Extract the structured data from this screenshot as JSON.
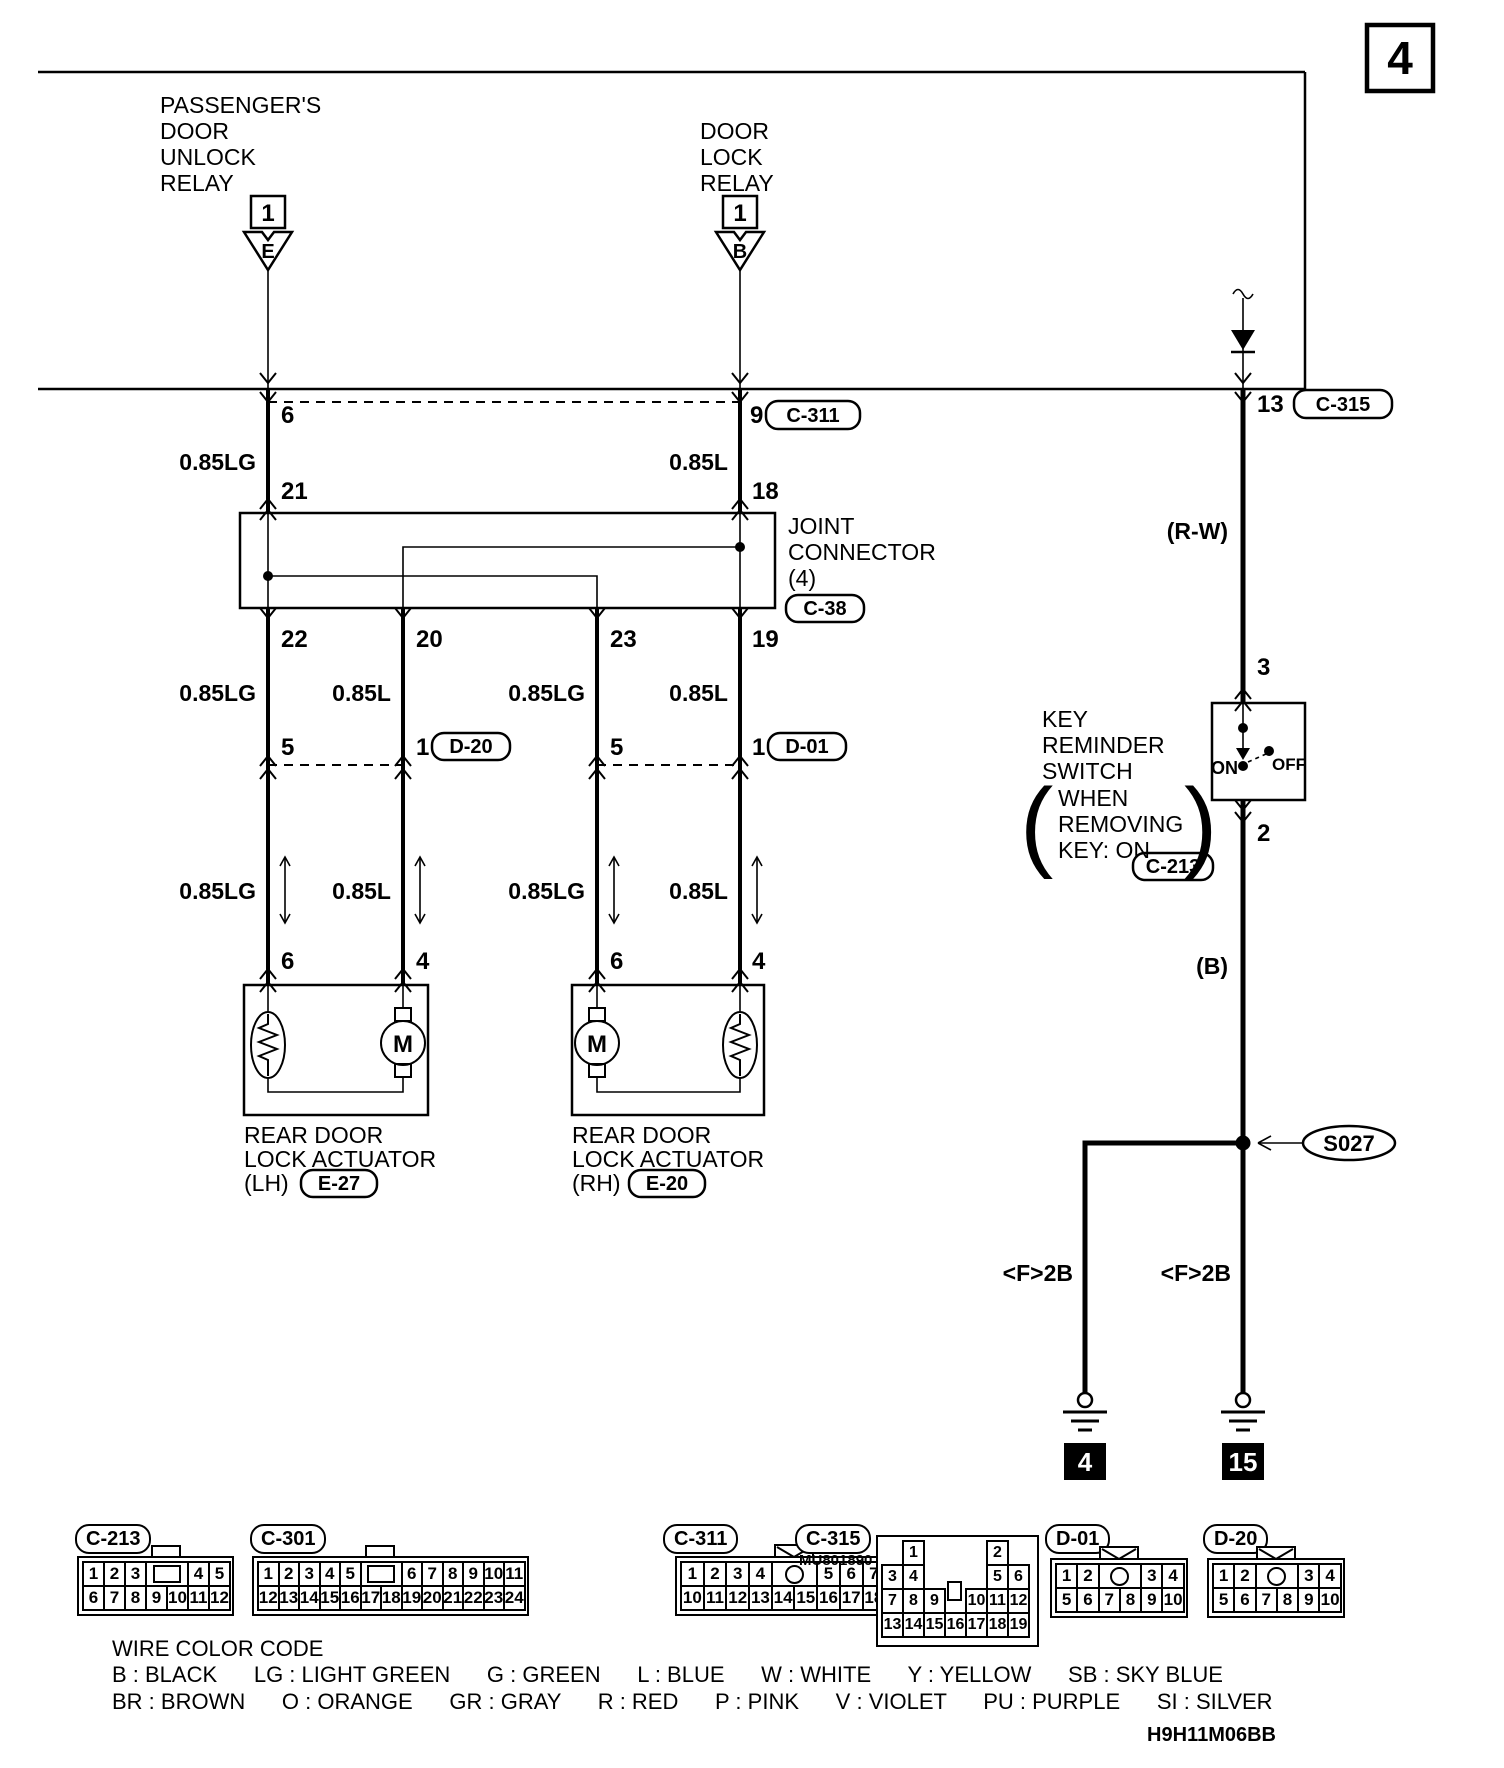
{
  "page": {
    "number": "4",
    "code": "H9H11M06BB"
  },
  "unlock_relay": {
    "line1": "PASSENGER'S",
    "line2": "DOOR",
    "line3": "UNLOCK",
    "line4": "RELAY",
    "pin": "1",
    "terminal": "E"
  },
  "lock_relay": {
    "line1": "DOOR",
    "line2": "LOCK",
    "line3": "RELAY",
    "pin": "1",
    "terminal": "B"
  },
  "columns": {
    "a": {
      "top_pin": "6",
      "top_gauge": "0.85LG",
      "jc_in": "21",
      "jc_out": "22",
      "gauge2": "0.85LG",
      "pin2": "5",
      "gauge3": "0.85LG",
      "act_pin": "6"
    },
    "b": {
      "jc_out": "20",
      "gauge2": "0.85L",
      "pin2": "1",
      "conn": "D-20",
      "gauge3": "0.85L",
      "act_pin": "4"
    },
    "c": {
      "jc_out": "23",
      "gauge2": "0.85LG",
      "pin2": "5",
      "gauge3": "0.85LG",
      "act_pin": "6"
    },
    "d": {
      "top_pin": "9",
      "top_conn": "C-311",
      "top_gauge": "0.85L",
      "jc_in": "18",
      "jc_out": "19",
      "gauge2": "0.85L",
      "pin2": "1",
      "conn": "D-01",
      "gauge3": "0.85L",
      "act_pin": "4"
    }
  },
  "joint_connector": {
    "line1": "JOINT",
    "line2": "CONNECTOR",
    "line3": "(4)",
    "code": "C-38"
  },
  "actuator_lh": {
    "line1": "REAR DOOR",
    "line2": "LOCK ACTUATOR",
    "line3": "(LH)",
    "code": "E-27",
    "motor": "M"
  },
  "actuator_rh": {
    "line1": "REAR DOOR",
    "line2": "LOCK ACTUATOR",
    "line3": "(RH)",
    "code": "E-20",
    "motor": "M"
  },
  "right": {
    "pin_top": "13",
    "conn_top": "C-315",
    "wire_top": "(R-W)",
    "pin3": "3",
    "pin2": "2",
    "wire_mid": "(B)",
    "splice": "S027",
    "sub_left": "<F>2B",
    "sub_right": "<F>2B",
    "ground_left": "4",
    "ground_right": "15"
  },
  "key_switch": {
    "line1": "KEY",
    "line2": "REMINDER",
    "line3": "SWITCH",
    "cond1": "WHEN",
    "cond2": "REMOVING",
    "cond3": "KEY: ON",
    "paren_open": "(",
    "paren_close": ")",
    "on": "ON",
    "off": "OFF",
    "code": "C-213"
  },
  "legend": {
    "title": "WIRE COLOR CODE",
    "line1": "B : BLACK      LG : LIGHT GREEN      G : GREEN      L : BLUE      W : WHITE      Y : YELLOW      SB : SKY BLUE",
    "line2": "BR : BROWN      O : ORANGE      GR : GRAY      R : RED      P : PINK      V : VIOLET      PU : PURPLE      SI : SILVER"
  },
  "connectors": [
    {
      "code": "C-213",
      "tab": "rect",
      "rows": [
        [
          "1",
          "2",
          "3",
          "#tab",
          "4",
          "5"
        ],
        [
          "6",
          "7",
          "8",
          "9",
          "10",
          "11",
          "12"
        ]
      ]
    },
    {
      "code": "C-301",
      "tab": "rect",
      "rows": [
        [
          "1",
          "2",
          "3",
          "4",
          "5",
          "#tab",
          "6",
          "7",
          "8",
          "9",
          "10",
          "11"
        ],
        [
          "12",
          "13",
          "14",
          "15",
          "16",
          "17",
          "18",
          "19",
          "20",
          "21",
          "22",
          "23",
          "24"
        ]
      ]
    },
    {
      "code": "C-311",
      "tab": "envelope",
      "rows": [
        [
          "1",
          "2",
          "3",
          "4",
          "#circle",
          "5",
          "6",
          "7",
          "8",
          "9"
        ],
        [
          "10",
          "11",
          "12",
          "13",
          "14",
          "15",
          "16",
          "17",
          "18",
          "19",
          "20"
        ]
      ]
    },
    {
      "code": "C-315",
      "note": "MU801890",
      "type": "matrix",
      "grid": [
        [
          null,
          "1",
          null,
          null,
          null,
          "2",
          null
        ],
        [
          "3",
          "4",
          null,
          null,
          null,
          "5",
          "6"
        ],
        [
          "7",
          "8",
          "9",
          "#tab",
          "10",
          "11",
          "12"
        ],
        [
          "13",
          "14",
          "15",
          "16",
          "17",
          "18",
          "19"
        ]
      ]
    },
    {
      "code": "D-01",
      "tab": "envelope",
      "rows": [
        [
          "1",
          "2",
          "#circle",
          "3",
          "4"
        ],
        [
          "5",
          "6",
          "7",
          "8",
          "9",
          "10"
        ]
      ]
    },
    {
      "code": "D-20",
      "tab": "envelope",
      "rows": [
        [
          "1",
          "2",
          "#circle",
          "3",
          "4"
        ],
        [
          "5",
          "6",
          "7",
          "8",
          "9",
          "10"
        ]
      ]
    }
  ]
}
